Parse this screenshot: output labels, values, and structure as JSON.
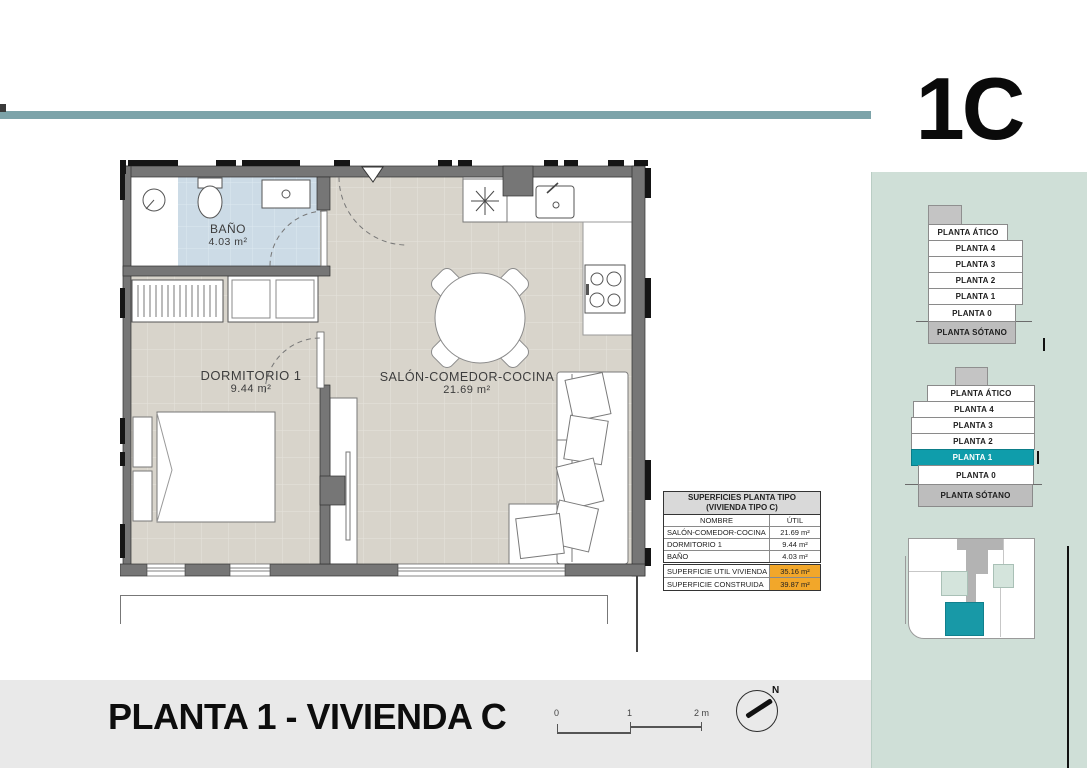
{
  "unit_label": "1C",
  "plan": {
    "rooms": {
      "salon": {
        "name": "SALÓN-COMEDOR-COCINA",
        "area": "21.69 m²"
      },
      "dormitorio": {
        "name": "DORMITORIO 1",
        "area": "9.44 m²"
      },
      "bano": {
        "name": "BAÑO",
        "area": "4.03 m²"
      }
    }
  },
  "surfaces_table": {
    "title_line1": "SUPERFICIES PLANTA TIPO",
    "title_line2": "(VIVIENDA TIPO C)",
    "columns": {
      "name": "NOMBRE",
      "util": "ÚTIL"
    },
    "rows": [
      {
        "name": "SALÓN-COMEDOR-COCINA",
        "value": "21.69 m²"
      },
      {
        "name": "DORMITORIO 1",
        "value": "9.44 m²"
      },
      {
        "name": "BAÑO",
        "value": "4.03 m²"
      }
    ],
    "totals": [
      {
        "name": "SUPERFICIE UTIL VIVIENDA",
        "value": "35.16 m²"
      },
      {
        "name": "SUPERFICIE CONSTRUIDA",
        "value": "39.87 m²"
      }
    ]
  },
  "floor_selector": {
    "floors": [
      "PLANTA ÁTICO",
      "PLANTA 4",
      "PLANTA 3",
      "PLANTA 2",
      "PLANTA 1",
      "PLANTA 0",
      "PLANTA SÓTANO"
    ],
    "highlighted_floor": "PLANTA 1"
  },
  "footer": {
    "title": "PLANTA 1 - VIVIENDA C",
    "scale": {
      "t0": "0",
      "t1": "1",
      "t2": "2 m"
    },
    "compass": "N"
  },
  "colors": {
    "accent_teal": "#0f9dab",
    "band_teal": "#7ca3a9",
    "panel_mint": "#cfdfd7",
    "highlight_orange": "#f2a72a",
    "floor_gray": "#d8d4cb",
    "bath_blue": "#ccdbe6",
    "wall_gray": "#767676"
  }
}
